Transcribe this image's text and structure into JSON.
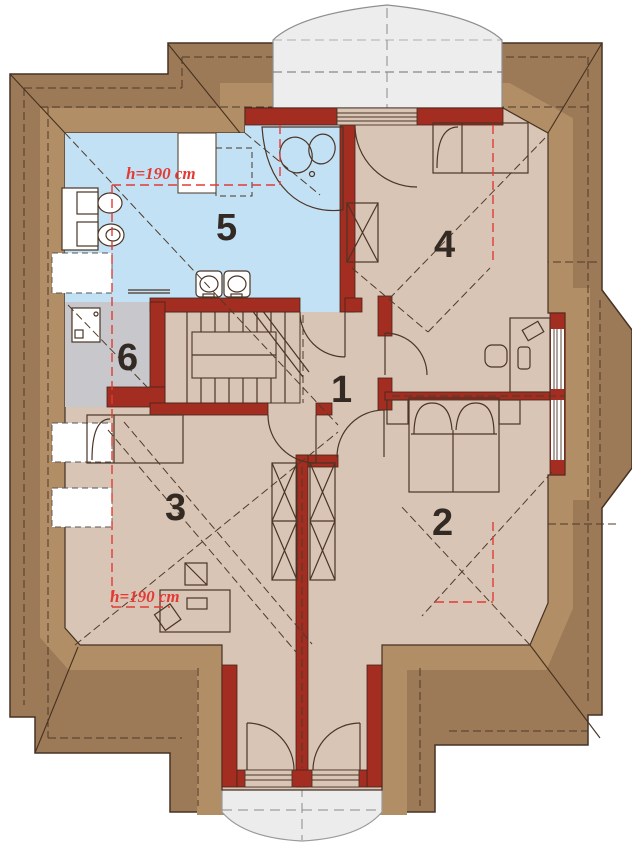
{
  "plan": {
    "type": "attic-floor-plan",
    "rooms": [
      {
        "number": "1"
      },
      {
        "number": "2"
      },
      {
        "number": "3"
      },
      {
        "number": "4"
      },
      {
        "number": "5"
      },
      {
        "number": "6"
      }
    ],
    "annotations": {
      "height_top": "h=190 cm",
      "height_bottom": "h=190 cm"
    },
    "colors": {
      "roof": "#9d7a57",
      "roof_inner": "#b28e67",
      "wall": "#a22d20",
      "floor": "#d9c5b6",
      "bathroom_floor": "#c3e1f5",
      "utility_floor": "#c8c7cb",
      "dormer": "#ededed",
      "balcony": "#ececec",
      "height_line": "#e23b35",
      "line": "#4a3526"
    }
  }
}
